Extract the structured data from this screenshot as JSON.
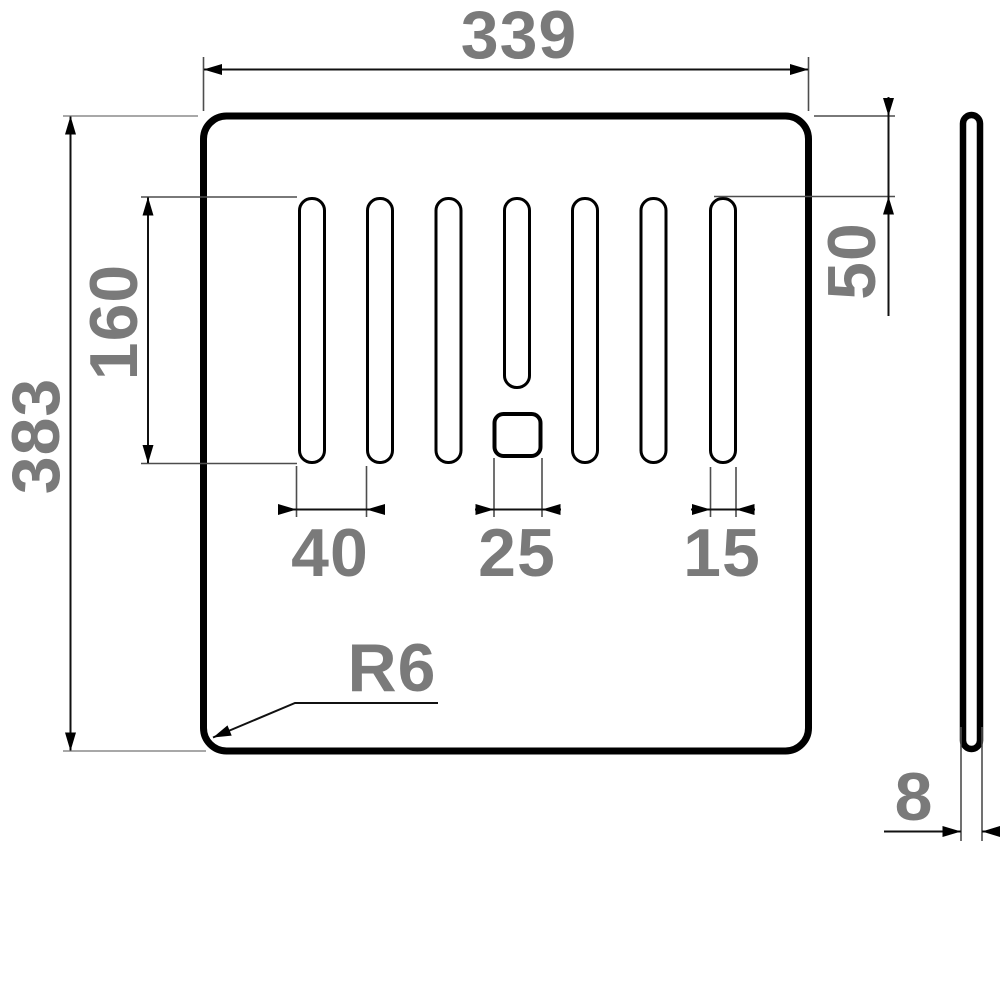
{
  "drawing": {
    "kind": "technical-dimension-drawing",
    "views": {
      "front": "plate-with-seven-drain-slots-and-square-hole",
      "side": "thin-profile"
    },
    "dimensions": {
      "overall_width": "339",
      "overall_height": "383",
      "slot_length": "160",
      "top_offset": "50",
      "slot_pitch": "40",
      "square_hole_width": "25",
      "slot_width": "15",
      "corner_radius": "R6",
      "thickness": "8"
    },
    "colors": {
      "line": "#000000",
      "dim_text": "#7a7a7a",
      "extension_line": "#4d4d4d",
      "background": "#ffffff"
    }
  }
}
